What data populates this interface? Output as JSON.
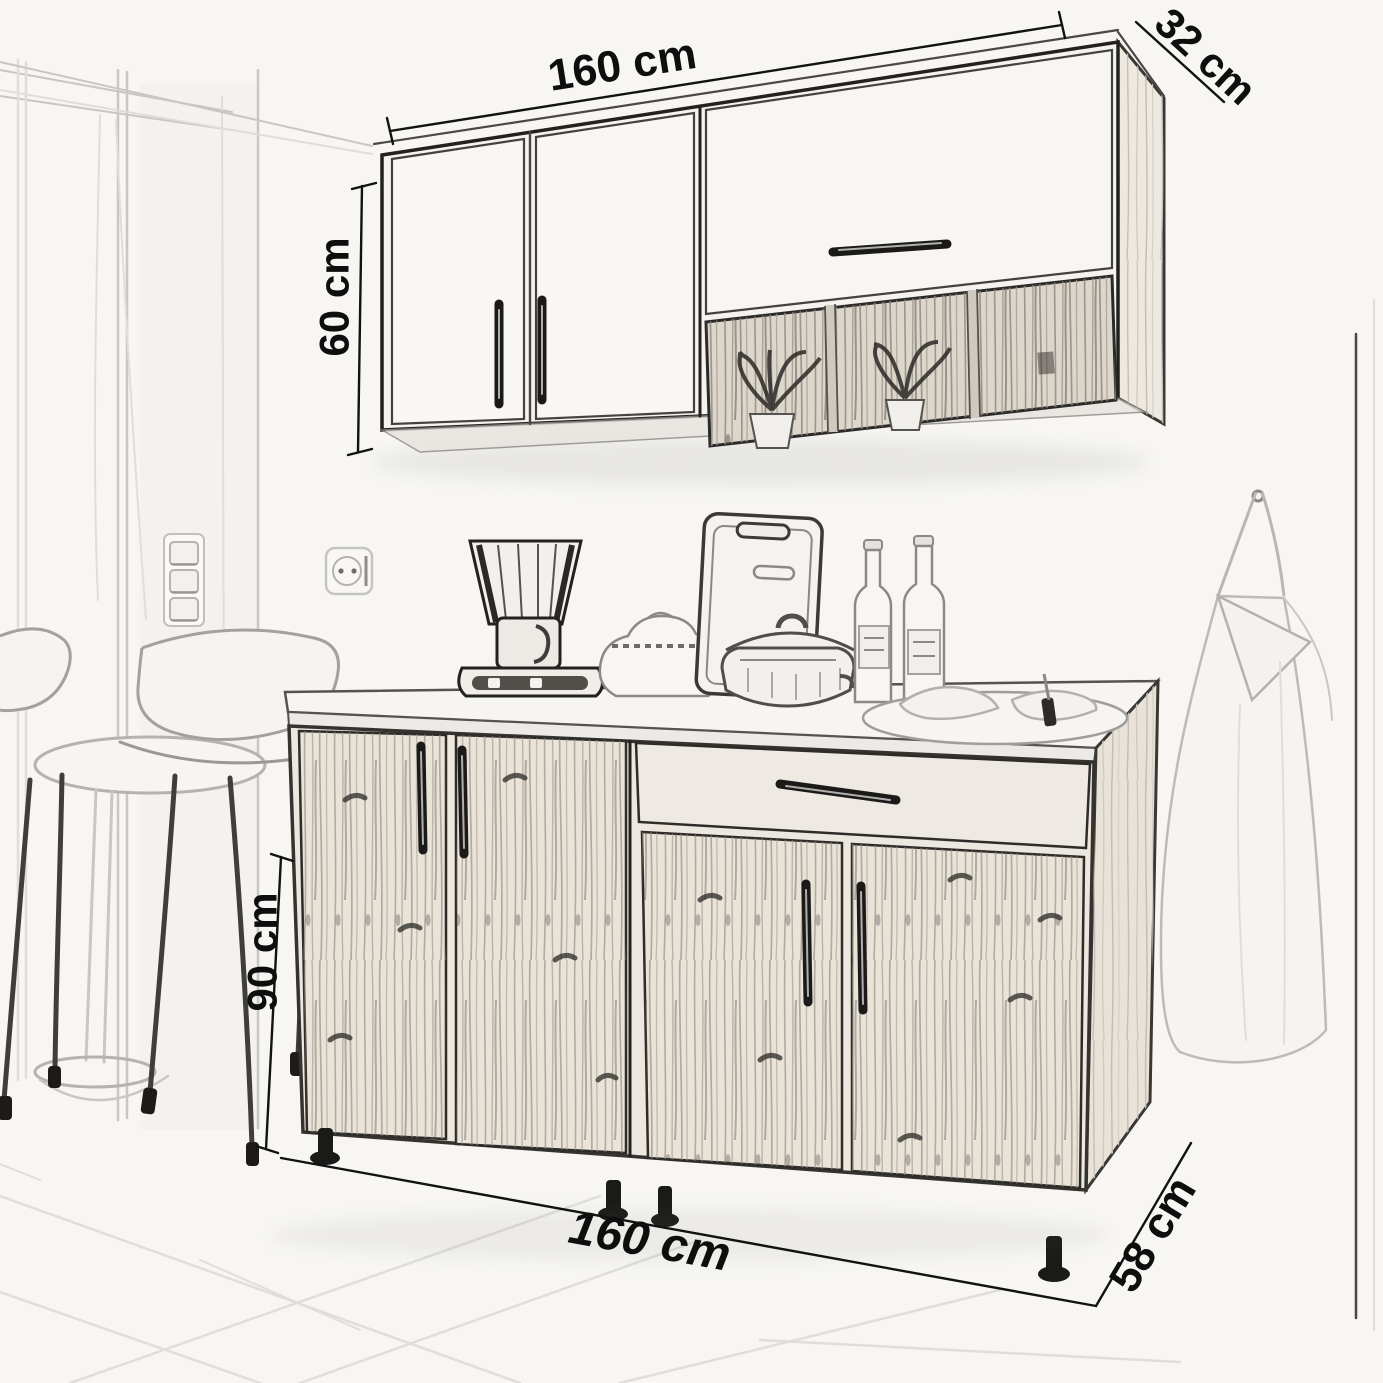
{
  "scene": {
    "kind": "kitchen cabinet set dimension sketch",
    "paper_color": "#f7f6f3",
    "ink_color": "#141414",
    "pencil_color": "#9a9895"
  },
  "labels": {
    "wall_width": "160 cm",
    "wall_depth": "32 cm",
    "wall_height": "60 cm",
    "base_height": "90 cm",
    "base_width": "160 cm",
    "base_depth": "58 cm"
  }
}
